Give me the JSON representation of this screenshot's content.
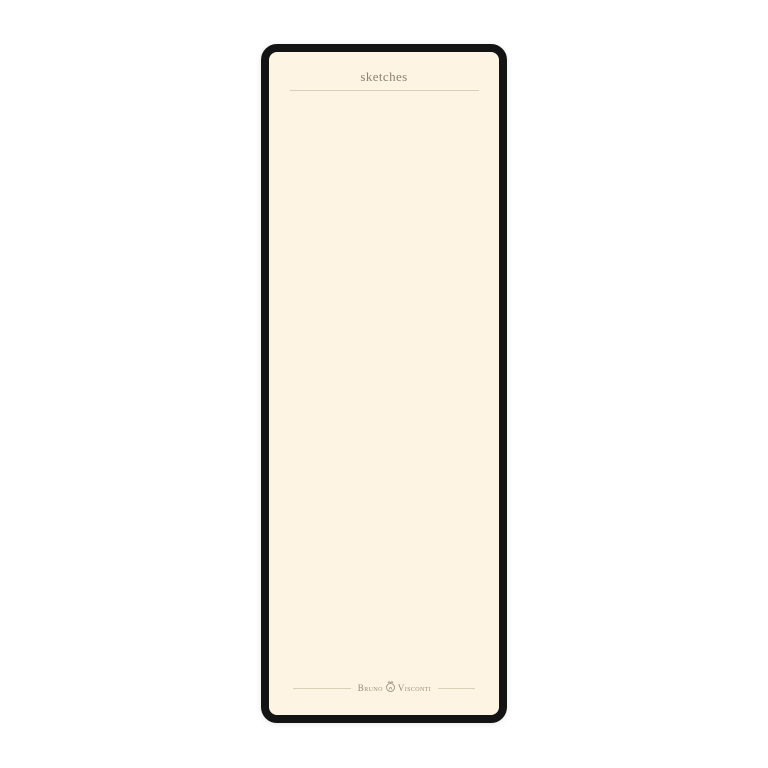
{
  "palette": {
    "page_bg": "#ffffff",
    "paper": "#fdf4e3",
    "frame": "#131313",
    "rule": "#d9cfb6",
    "title_text": "#8d8374",
    "brand_text": "#9a8c76"
  },
  "notepad": {
    "title": "sketches",
    "brand": {
      "name_left": "Bruno",
      "name_right": "Visconti"
    }
  }
}
